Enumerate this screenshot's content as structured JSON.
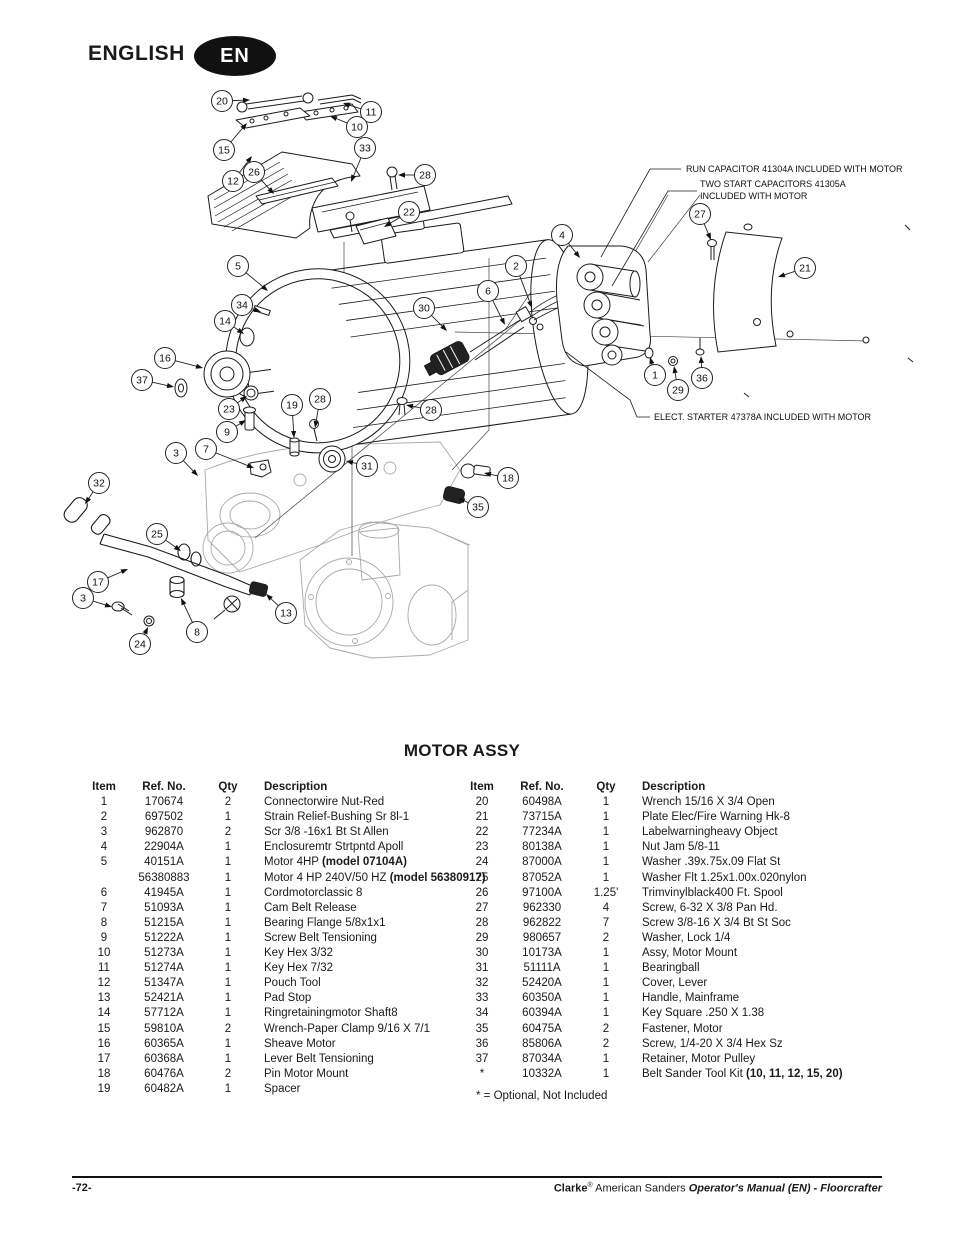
{
  "header": {
    "language_label": "ENGLISH",
    "badge": "EN"
  },
  "diagram": {
    "annotations": [
      {
        "text": "RUN CAPACITOR 41304A INCLUDED WITH MOTOR",
        "x": 686,
        "y": 172
      },
      {
        "text": "TWO START CAPACITORS 41305A",
        "x": 700,
        "y": 187
      },
      {
        "text": "INCLUDED WITH MOTOR",
        "x": 700,
        "y": 199
      },
      {
        "text": "ELECT. STARTER 47378A INCLUDED WITH MOTOR",
        "x": 654,
        "y": 420
      }
    ],
    "callouts": [
      {
        "n": "20",
        "x": 222,
        "y": 101,
        "tx": 250,
        "ty": 100
      },
      {
        "n": "11",
        "x": 371,
        "y": 112,
        "tx": 343,
        "ty": 103
      },
      {
        "n": "10",
        "x": 357,
        "y": 127,
        "tx": 330,
        "ty": 116
      },
      {
        "n": "15",
        "x": 224,
        "y": 150,
        "tx": 247,
        "ty": 123
      },
      {
        "n": "12",
        "x": 233,
        "y": 181,
        "tx": 252,
        "ty": 156
      },
      {
        "n": "26",
        "x": 254,
        "y": 172,
        "tx": 274,
        "ty": 194
      },
      {
        "n": "33",
        "x": 365,
        "y": 148,
        "tx": 351,
        "ty": 182
      },
      {
        "n": "28",
        "x": 425,
        "y": 175,
        "tx": 398,
        "ty": 175
      },
      {
        "n": "22",
        "x": 409,
        "y": 212,
        "tx": 384,
        "ty": 227
      },
      {
        "n": "5",
        "x": 238,
        "y": 266,
        "tx": 268,
        "ty": 291
      },
      {
        "n": "4",
        "x": 562,
        "y": 235,
        "tx": 580,
        "ty": 258
      },
      {
        "n": "2",
        "x": 516,
        "y": 266,
        "tx": 532,
        "ty": 308
      },
      {
        "n": "6",
        "x": 488,
        "y": 291,
        "tx": 505,
        "ty": 325
      },
      {
        "n": "27",
        "x": 700,
        "y": 214,
        "tx": 711,
        "ty": 240
      },
      {
        "n": "21",
        "x": 805,
        "y": 268,
        "tx": 778,
        "ty": 277
      },
      {
        "n": "34",
        "x": 242,
        "y": 305,
        "tx": 261,
        "ty": 312
      },
      {
        "n": "30",
        "x": 424,
        "y": 308,
        "tx": 447,
        "ty": 331
      },
      {
        "n": "14",
        "x": 225,
        "y": 321,
        "tx": 244,
        "ty": 334
      },
      {
        "n": "16",
        "x": 165,
        "y": 358,
        "tx": 203,
        "ty": 368
      },
      {
        "n": "37",
        "x": 142,
        "y": 380,
        "tx": 174,
        "ty": 387
      },
      {
        "n": "1",
        "x": 655,
        "y": 375,
        "tx": 650,
        "ty": 357
      },
      {
        "n": "36",
        "x": 702,
        "y": 378,
        "tx": 701,
        "ty": 356
      },
      {
        "n": "29",
        "x": 678,
        "y": 390,
        "tx": 674,
        "ty": 366
      },
      {
        "n": "23",
        "x": 229,
        "y": 409,
        "tx": 247,
        "ty": 396
      },
      {
        "n": "19",
        "x": 292,
        "y": 405,
        "tx": 294,
        "ty": 438
      },
      {
        "n": "28",
        "x": 320,
        "y": 399,
        "tx": 315,
        "ty": 428
      },
      {
        "n": "9",
        "x": 227,
        "y": 432,
        "tx": 246,
        "ty": 420
      },
      {
        "n": "3",
        "x": 176,
        "y": 453,
        "tx": 198,
        "ty": 476
      },
      {
        "n": "7",
        "x": 206,
        "y": 449,
        "tx": 254,
        "ty": 468
      },
      {
        "n": "31",
        "x": 367,
        "y": 466,
        "tx": 346,
        "ty": 461
      },
      {
        "n": "28",
        "x": 431,
        "y": 410,
        "tx": 406,
        "ty": 405
      },
      {
        "n": "18",
        "x": 508,
        "y": 478,
        "tx": 484,
        "ty": 473
      },
      {
        "n": "35",
        "x": 478,
        "y": 507,
        "tx": 458,
        "ty": 498
      },
      {
        "n": "32",
        "x": 99,
        "y": 483,
        "tx": 85,
        "ty": 504
      },
      {
        "n": "25",
        "x": 157,
        "y": 534,
        "tx": 181,
        "ty": 551
      },
      {
        "n": "17",
        "x": 98,
        "y": 582,
        "tx": 128,
        "ty": 569
      },
      {
        "n": "3",
        "x": 83,
        "y": 598,
        "tx": 112,
        "ty": 607
      },
      {
        "n": "24",
        "x": 140,
        "y": 644,
        "tx": 148,
        "ty": 627
      },
      {
        "n": "8",
        "x": 197,
        "y": 632,
        "tx": 181,
        "ty": 598
      },
      {
        "n": "13",
        "x": 286,
        "y": 613,
        "tx": 266,
        "ty": 594
      }
    ]
  },
  "parts_table": {
    "title": "MOTOR ASSY",
    "headers": {
      "item": "Item",
      "ref": "Ref. No.",
      "qty": "Qty",
      "desc": "Description"
    },
    "left_rows": [
      {
        "item": "1",
        "ref": "170674",
        "qty": "2",
        "desc": "Connectorwire Nut-Red",
        "desc_bold": ""
      },
      {
        "item": "2",
        "ref": "697502",
        "qty": "1",
        "desc": "Strain Relief-Bushing Sr 8l-1",
        "desc_bold": ""
      },
      {
        "item": "3",
        "ref": "962870",
        "qty": "2",
        "desc": "Scr 3/8 -16x1 Bt St Allen",
        "desc_bold": ""
      },
      {
        "item": "4",
        "ref": "22904A",
        "qty": "1",
        "desc": "Enclosuremtr Strtpntd Apoll",
        "desc_bold": ""
      },
      {
        "item": "5",
        "ref": "40151A",
        "qty": "1",
        "desc": "Motor 4HP",
        "desc_bold": "(model 07104A)"
      },
      {
        "item": "",
        "ref": "56380883",
        "qty": "1",
        "desc": "Motor 4 HP 240V/50 HZ",
        "desc_bold": "(model 56380917)"
      },
      {
        "item": "6",
        "ref": "41945A",
        "qty": "1",
        "desc": "Cordmotorclassic 8",
        "desc_bold": ""
      },
      {
        "item": "7",
        "ref": "51093A",
        "qty": "1",
        "desc": "Cam Belt Release",
        "desc_bold": ""
      },
      {
        "item": "8",
        "ref": "51215A",
        "qty": "1",
        "desc": "Bearing Flange 5/8x1x1",
        "desc_bold": ""
      },
      {
        "item": "9",
        "ref": "51222A",
        "qty": "1",
        "desc": "Screw Belt Tensioning",
        "desc_bold": ""
      },
      {
        "item": "10",
        "ref": "51273A",
        "qty": "1",
        "desc": "Key Hex 3/32",
        "desc_bold": ""
      },
      {
        "item": "11",
        "ref": "51274A",
        "qty": "1",
        "desc": "Key Hex 7/32",
        "desc_bold": ""
      },
      {
        "item": "12",
        "ref": "51347A",
        "qty": "1",
        "desc": "Pouch Tool",
        "desc_bold": ""
      },
      {
        "item": "13",
        "ref": "52421A",
        "qty": "1",
        "desc": "Pad Stop",
        "desc_bold": ""
      },
      {
        "item": "14",
        "ref": "57712A",
        "qty": "1",
        "desc": "Ringretainingmotor Shaft8",
        "desc_bold": ""
      },
      {
        "item": "15",
        "ref": "59810A",
        "qty": "2",
        "desc": "Wrench-Paper Clamp 9/16 X 7/1",
        "desc_bold": ""
      },
      {
        "item": "16",
        "ref": "60365A",
        "qty": "1",
        "desc": "Sheave Motor",
        "desc_bold": ""
      },
      {
        "item": "17",
        "ref": "60368A",
        "qty": "1",
        "desc": "Lever Belt Tensioning",
        "desc_bold": ""
      },
      {
        "item": "18",
        "ref": "60476A",
        "qty": "2",
        "desc": "Pin Motor Mount",
        "desc_bold": ""
      },
      {
        "item": "19",
        "ref": "60482A",
        "qty": "1",
        "desc": "Spacer",
        "desc_bold": ""
      }
    ],
    "right_rows": [
      {
        "item": "20",
        "ref": "60498A",
        "qty": "1",
        "desc": "Wrench 15/16 X 3/4 Open",
        "desc_bold": ""
      },
      {
        "item": "21",
        "ref": "73715A",
        "qty": "1",
        "desc": "Plate Elec/Fire Warning Hk-8",
        "desc_bold": ""
      },
      {
        "item": "22",
        "ref": "77234A",
        "qty": "1",
        "desc": "Labelwarningheavy Object",
        "desc_bold": ""
      },
      {
        "item": "23",
        "ref": "80138A",
        "qty": "1",
        "desc": "Nut Jam 5/8-11",
        "desc_bold": ""
      },
      {
        "item": "24",
        "ref": "87000A",
        "qty": "1",
        "desc": "Washer .39x.75x.09 Flat St",
        "desc_bold": ""
      },
      {
        "item": "25",
        "ref": "87052A",
        "qty": "1",
        "desc": "Washer Flt 1.25x1.00x.020nylon",
        "desc_bold": ""
      },
      {
        "item": "26",
        "ref": "97100A",
        "qty": "1.25'",
        "desc": "Trimvinylblack400 Ft. Spool",
        "desc_bold": ""
      },
      {
        "item": "27",
        "ref": "962330",
        "qty": "4",
        "desc": "Screw, 6-32 X 3/8 Pan Hd.",
        "desc_bold": ""
      },
      {
        "item": "28",
        "ref": "962822",
        "qty": "7",
        "desc": "Screw 3/8-16 X 3/4 Bt St Soc",
        "desc_bold": ""
      },
      {
        "item": "29",
        "ref": "980657",
        "qty": "2",
        "desc": "Washer, Lock 1/4",
        "desc_bold": ""
      },
      {
        "item": "30",
        "ref": "10173A",
        "qty": "1",
        "desc": "Assy, Motor Mount",
        "desc_bold": ""
      },
      {
        "item": "31",
        "ref": "51111A",
        "qty": "1",
        "desc": "Bearingball",
        "desc_bold": ""
      },
      {
        "item": "32",
        "ref": "52420A",
        "qty": "1",
        "desc": "Cover, Lever",
        "desc_bold": ""
      },
      {
        "item": "33",
        "ref": "60350A",
        "qty": "1",
        "desc": "Handle, Mainframe",
        "desc_bold": ""
      },
      {
        "item": "34",
        "ref": "60394A",
        "qty": "1",
        "desc": "Key Square .250 X 1.38",
        "desc_bold": ""
      },
      {
        "item": "35",
        "ref": "60475A",
        "qty": "2",
        "desc": "Fastener, Motor",
        "desc_bold": ""
      },
      {
        "item": "36",
        "ref": "85806A",
        "qty": "2",
        "desc": "Screw, 1/4-20 X 3/4 Hex Sz",
        "desc_bold": ""
      },
      {
        "item": "37",
        "ref": "87034A",
        "qty": "1",
        "desc": "Retainer, Motor Pulley",
        "desc_bold": ""
      },
      {
        "item": "*",
        "ref": "10332A",
        "qty": "1",
        "desc": "Belt Sander Tool Kit",
        "desc_bold": "(10, 11, 12, 15, 20)"
      }
    ],
    "footnote": "* = Optional, Not Included"
  },
  "footer": {
    "page_number": "-72-",
    "brand": "Clarke",
    "registered": "®",
    "brand_suffix": "American Sanders",
    "manual_title": "Operator's Manual (EN) - Floorcrafter"
  }
}
